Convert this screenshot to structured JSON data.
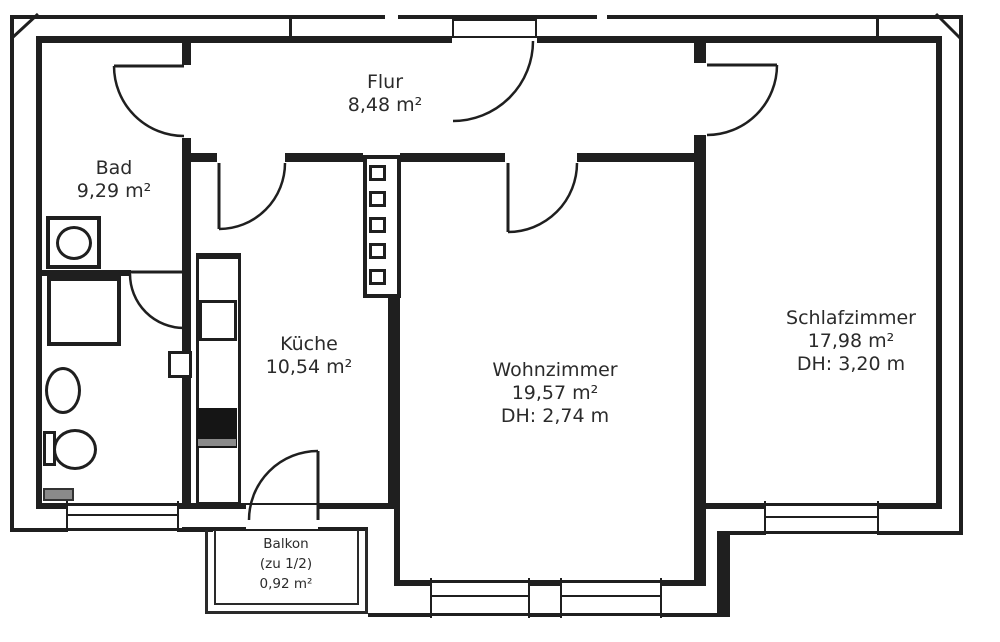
{
  "plan": {
    "type": "apartment-floorplan",
    "colors": {
      "wall": "#1f1f1f",
      "text": "#2b2b2b",
      "radiator_gray": "#8a8a8a",
      "stove_black": "#151515"
    },
    "rooms": {
      "flur": {
        "name": "Flur",
        "area": "8,48 m²"
      },
      "bad": {
        "name": "Bad",
        "area": "9,29 m²"
      },
      "kueche": {
        "name": "Küche",
        "area": "10,54 m²"
      },
      "wohnzimmer": {
        "name": "Wohnzimmer",
        "area": "19,57 m²",
        "ceiling": "DH: 2,74 m"
      },
      "schlafzimmer": {
        "name": "Schlafzimmer",
        "area": "17,98 m²",
        "ceiling": "DH: 3,20 m"
      },
      "balkon": {
        "name": "Balkon",
        "share": "(zu 1/2)",
        "area": "0,92 m²"
      }
    },
    "fixtures": [
      "washing-machine",
      "shower-tray",
      "washbasin",
      "toilet",
      "radiator",
      "kitchen-counter",
      "kitchen-sink",
      "stove",
      "installation-shaft",
      "vent-box"
    ],
    "doors": [
      "entrance-door",
      "bad-door",
      "bad-inner-door",
      "kueche-door",
      "wohnzimmer-door",
      "schlafzimmer-door",
      "balkon-door"
    ],
    "windows": [
      "bad-window",
      "wohnzimmer-window-1",
      "wohnzimmer-window-2",
      "schlafzimmer-window"
    ]
  }
}
